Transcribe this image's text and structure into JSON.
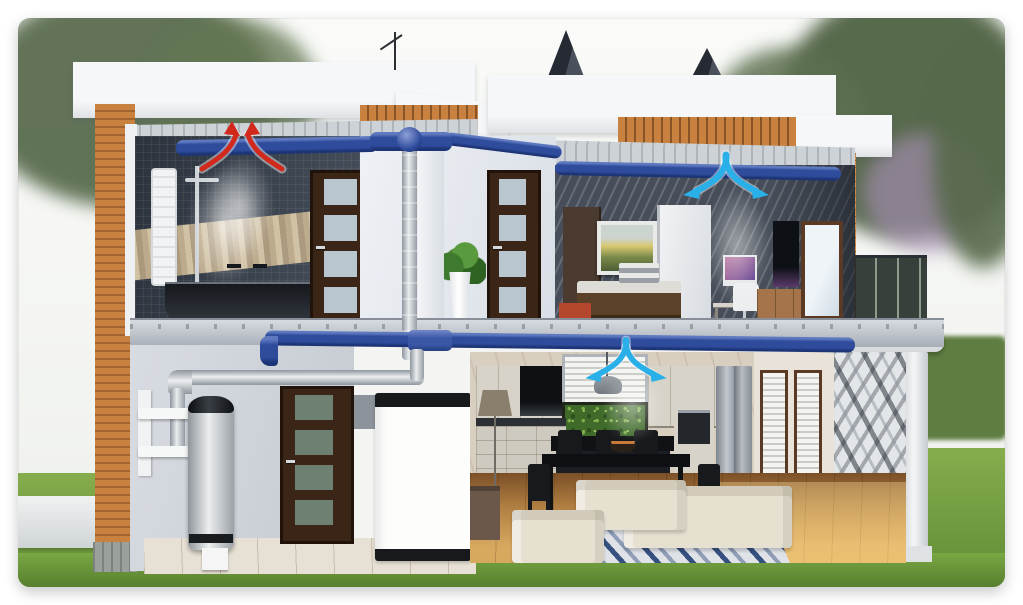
{
  "scene": {
    "kind": "house-ventilation-cutaway-illustration",
    "rooms": [
      "bathroom",
      "hallway-upstairs",
      "bedroom-office",
      "entry-porch",
      "utility",
      "kitchen",
      "dining-area",
      "living-room",
      "terrace"
    ],
    "equipment": [
      "blue-ceiling-duct-network",
      "vertical-riser-duct",
      "silver-fresh-air-piping",
      "heat-pump-water-heater",
      "ventilation-unit",
      "wall-mounting-bracket",
      "roof-pyramid-vents"
    ],
    "airflow": {
      "extract_points": [
        {
          "room": "bathroom",
          "direction": "up-into-ceiling-duct"
        }
      ],
      "supply_points": [
        {
          "room": "bedroom-office",
          "direction": "down-from-ceiling-duct"
        },
        {
          "room": "kitchen",
          "direction": "down-from-ceiling-duct"
        }
      ]
    }
  },
  "colors": {
    "page_bg": "#ffffff",
    "sky": "#f2f4f1",
    "tree_green": "#55684a",
    "blossom_purple": "#a78fb4",
    "hedge_green": "#5f7d41",
    "grass_green": "#6f9d3f",
    "roof_white": "#f4f5f6",
    "wood_siding_orange": "#c9813f",
    "duct_blue": "#2e4b9c",
    "duct_silver": "#ced3d9",
    "supply_arrow_cyan": "#29b0e8",
    "extract_arrow_red": "#d3281c",
    "arrow_glow_white": "#ffffff",
    "bath_tile_dark": "#39414d",
    "mosaic_beige": "#cdbb9b",
    "door_walnut": "#3a2517",
    "wall_light_gray": "#ccd1d8",
    "cabinet_cream": "#d6d1c6",
    "plant_wall_green": "#3f6a2a",
    "floor_wood": "#b5854d",
    "slab_gray": "#b7bcc2",
    "tank_gray": "#dfe2e5",
    "accent_red_bench": "#b5462e"
  }
}
